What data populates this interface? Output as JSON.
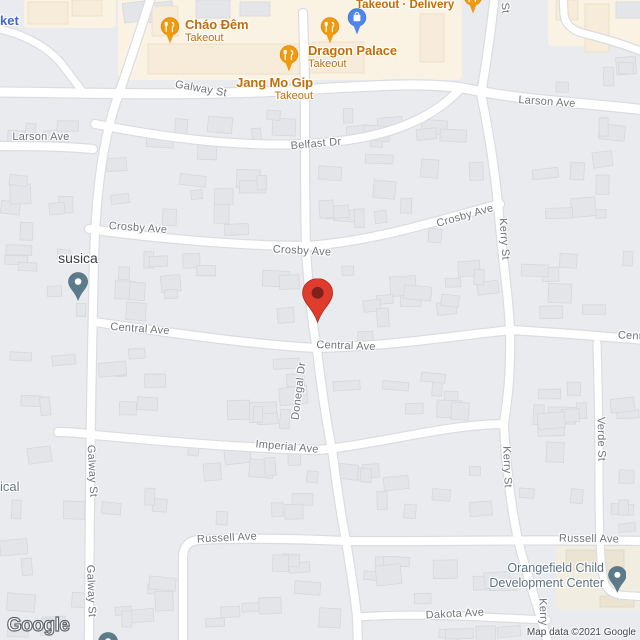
{
  "map": {
    "background": "#e9ebee",
    "road_fill": "#ffffff",
    "road_casing": "#dadce0",
    "building_fill": "#e3e5e9",
    "building_stroke": "#d5d8dc",
    "commercial_area_fill": "#faf3e4",
    "commercial_building_fill": "#f7ecd9",
    "commercial_building_stroke": "#eddec1",
    "school_area_fill": "#f1eee1",
    "school_building_fill": "#ebe4d3",
    "school_building_stroke": "#dfd5bd",
    "street_label_color": "#70757a",
    "food_pin_color": "#f09a10",
    "shopping_pin_color": "#4e86ec",
    "place_pin_color": "#5c7b8a",
    "destination_pin_color": "#df3c2d",
    "destination_pin_inner": "#7e231b",
    "areas": [
      {
        "x": 118,
        "y": -6,
        "w": 344,
        "h": 86,
        "fill": "commercial_area_fill"
      },
      {
        "x": 548,
        "y": -6,
        "w": 98,
        "h": 52,
        "fill": "commercial_area_fill"
      },
      {
        "x": 24,
        "y": -6,
        "w": 92,
        "h": 34,
        "fill": "commercial_area_fill"
      },
      {
        "x": 556,
        "y": 546,
        "w": 90,
        "h": 64,
        "fill": "school_area_fill"
      }
    ],
    "commercial_buildings": [
      {
        "x": 148,
        "y": 44,
        "w": 162,
        "h": 30
      },
      {
        "x": 312,
        "y": 42,
        "w": 52,
        "h": 31
      },
      {
        "x": 420,
        "y": 14,
        "w": 24,
        "h": 48
      },
      {
        "x": 585,
        "y": 4,
        "w": 24,
        "h": 48
      },
      {
        "x": 556,
        "y": 0,
        "w": 22,
        "h": 20
      },
      {
        "x": 28,
        "y": 2,
        "w": 40,
        "h": 22
      },
      {
        "x": 72,
        "y": 0,
        "w": 30,
        "h": 16
      },
      {
        "x": 152,
        "y": 6,
        "w": 26,
        "h": 30
      }
    ],
    "school_buildings": [
      {
        "x": 566,
        "y": 550,
        "w": 58,
        "h": 20
      },
      {
        "x": 600,
        "y": 596,
        "w": 34,
        "h": 11
      }
    ],
    "gray_structures": [
      {
        "x": 616,
        "y": 2,
        "w": 26,
        "h": 16
      },
      {
        "x": 196,
        "y": 0,
        "w": 34,
        "h": 18
      },
      {
        "x": 240,
        "y": 2,
        "w": 30,
        "h": 14
      }
    ],
    "blocks": [
      [
        0,
        100,
        88,
        52,
        4
      ],
      [
        0,
        172,
        86,
        466,
        26
      ],
      [
        105,
        108,
        192,
        130,
        18
      ],
      [
        315,
        103,
        175,
        142,
        20
      ],
      [
        100,
        248,
        205,
        84,
        13
      ],
      [
        322,
        255,
        180,
        86,
        14
      ],
      [
        95,
        342,
        215,
        92,
        14
      ],
      [
        330,
        358,
        172,
        64,
        9
      ],
      [
        100,
        443,
        222,
        88,
        14
      ],
      [
        338,
        458,
        164,
        74,
        10
      ],
      [
        196,
        552,
        148,
        84,
        9
      ],
      [
        360,
        548,
        172,
        58,
        9
      ],
      [
        362,
        626,
        168,
        16,
        4
      ],
      [
        518,
        112,
        122,
        215,
        16
      ],
      [
        518,
        348,
        74,
        184,
        11
      ],
      [
        606,
        348,
        34,
        184,
        6
      ],
      [
        538,
        56,
        102,
        38,
        4
      ],
      [
        104,
        548,
        72,
        90,
        6
      ],
      [
        118,
        2,
        62,
        30,
        3
      ]
    ],
    "roads": [
      {
        "d": "M -6,92 C 60,92 180,97 300,90 C 380,85 432,82 468,89 C 520,100 575,102 646,110",
        "w": 9
      },
      {
        "d": "M 152,-6 C 143,22 130,62 117,99",
        "w": 8
      },
      {
        "d": "M 117,99 C 103,140 96,190 94,260 C 92,350 90,430 89,646",
        "w": 8
      },
      {
        "d": "M -6,146 C 30,146 60,146 93,149",
        "w": 8
      },
      {
        "d": "M 95,124 C 180,141 262,149 332,142 C 392,136 434,117 460,89",
        "w": 8
      },
      {
        "d": "M 495,-6 C 492,20 488,55 481,94 C 489,132 496,176 500,226 C 505,280 509,302 510,330 C 511,380 507,400 504,424 C 506,470 511,506 518,540 C 528,580 541,616 549,646",
        "w": 8
      },
      {
        "d": "M 563,-6 L 564,14 C 565,25 573,31 586,34 C 606,39 626,45 646,53",
        "w": 7
      },
      {
        "d": "M 89,229 C 150,238 242,246 307,246 C 380,241 452,216 500,204",
        "w": 8
      },
      {
        "d": "M 94,322 C 160,331 252,345 318,348 C 392,346 452,336 512,330 C 560,333 600,336 646,340",
        "w": 8
      },
      {
        "d": "M 303,13 C 304,50 305,70 305,94 C 305,160 305,212 306,248 C 309,300 313,326 317,350 C 323,402 328,430 333,456 C 338,496 342,520 346,541 C 351,572 355,596 357,617 L 358,646",
        "w": 8
      },
      {
        "d": "M 58,432 C 70,432 82,433 94,435 C 160,441 242,448 318,450 C 362,446 420,432 462,427 C 480,425 494,424 504,424",
        "w": 8
      },
      {
        "d": "M 183,648 L 183,558 Q 183,541 199,540 C 258,537 320,540 346,541 C 430,542 520,539 646,541",
        "w": 8
      },
      {
        "d": "M 358,617 C 400,614 442,615 482,617 C 506,618 526,619 547,620",
        "w": 7
      },
      {
        "d": "M 597,343 C 598,380 599,420 599,460 C 599,500 599,524 600,540 C 601,562 602,574 605,584 Q 609,593 620,595 C 628,596 637,596 646,597",
        "w": 7
      },
      {
        "d": "M -6,28 C 18,32 44,44 60,62 C 68,72 76,83 82,91",
        "w": 7
      }
    ]
  },
  "streets": [
    {
      "text": "Galway St",
      "x": 201,
      "y": 89,
      "rot": 10
    },
    {
      "text": "Larson Ave",
      "x": 41,
      "y": 137,
      "rot": 0
    },
    {
      "text": "Larson Ave",
      "x": 547,
      "y": 102,
      "rot": 4
    },
    {
      "text": "Belfast Dr",
      "x": 316,
      "y": 144,
      "rot": -5
    },
    {
      "text": "Crosby Ave",
      "x": 138,
      "y": 228,
      "rot": 4
    },
    {
      "text": "Crosby Ave",
      "x": 302,
      "y": 251,
      "rot": 3
    },
    {
      "text": "Crosby Ave",
      "x": 465,
      "y": 216,
      "rot": -16
    },
    {
      "text": "Central Ave",
      "x": 140,
      "y": 329,
      "rot": 4
    },
    {
      "text": "Central Ave",
      "x": 346,
      "y": 346,
      "rot": 2
    },
    {
      "text": "Cent",
      "x": 630,
      "y": 336,
      "rot": 3
    },
    {
      "text": "Donegal Dr",
      "x": 299,
      "y": 391,
      "rot": -83
    },
    {
      "text": "Imperial Ave",
      "x": 287,
      "y": 447,
      "rot": 5
    },
    {
      "text": "Galway St",
      "x": 92,
      "y": 471,
      "rot": 87
    },
    {
      "text": "Galway St",
      "x": 91,
      "y": 591,
      "rot": 88
    },
    {
      "text": "Kerry St",
      "x": 504,
      "y": 239,
      "rot": 86
    },
    {
      "text": "Kerry St",
      "x": 507,
      "y": 467,
      "rot": 88
    },
    {
      "text": "Kerry",
      "x": 543,
      "y": 612,
      "rot": 87
    },
    {
      "text": "Verde St",
      "x": 601,
      "y": 439,
      "rot": 89
    },
    {
      "text": "Russell Ave",
      "x": 227,
      "y": 538,
      "rot": -3
    },
    {
      "text": "Russell Ave",
      "x": 589,
      "y": 539,
      "rot": 1
    },
    {
      "text": "Dakota Ave",
      "x": 455,
      "y": 614,
      "rot": -3
    },
    {
      "text": "St",
      "x": 505,
      "y": 8,
      "rot": 85
    }
  ],
  "pois": [
    {
      "id": "chao-dem",
      "type": "restaurant",
      "name": "Cháo Đêm",
      "sub": "Takeout",
      "pin": {
        "x": 170,
        "y": 43,
        "s": 1
      },
      "label": {
        "x": 185,
        "y": 18,
        "align": "left"
      }
    },
    {
      "id": "dragon-palace",
      "type": "restaurant",
      "name": "Dragon Palace",
      "sub": "Takeout",
      "pin": {
        "x": 330,
        "y": 43,
        "s": 1
      },
      "label": {
        "x": 308,
        "y": 44,
        "align": "left"
      }
    },
    {
      "id": "jang-mo-gip",
      "type": "restaurant",
      "name": "Jang Mo Gip",
      "sub": "Takeout",
      "pin": {
        "x": 289,
        "y": 71,
        "s": 1
      },
      "label": {
        "x": 313,
        "y": 76,
        "align": "right"
      }
    },
    {
      "id": "takeout-delivery",
      "type": "food-sub",
      "sub": "Takeout · Delivery",
      "label": {
        "x": 356,
        "y": -1,
        "align": "left"
      }
    },
    {
      "id": "restaurant-partial-top",
      "type": "restaurant",
      "pin": {
        "x": 473,
        "y": 13,
        "s": 1
      }
    },
    {
      "id": "shopping-place",
      "type": "shopping",
      "pin": {
        "x": 357,
        "y": 34,
        "s": 1
      }
    },
    {
      "id": "market-partial",
      "type": "shop-label",
      "name": "ket",
      "label": {
        "x": 0,
        "y": 13,
        "align": "left"
      }
    },
    {
      "id": "medical-partial",
      "type": "gray-label",
      "name": "ical",
      "label": {
        "x": 0,
        "y": 479,
        "align": "left"
      }
    },
    {
      "id": "susica",
      "type": "place",
      "name": "susica",
      "pin": {
        "x": 78,
        "y": 301,
        "s": 0.84
      },
      "label": {
        "x": 78,
        "y": 250,
        "align": "center"
      }
    },
    {
      "id": "orangefield-center",
      "type": "place2",
      "name": "Orangefield Child",
      "name2": "Development Center",
      "pin": {
        "x": 617,
        "y": 593,
        "s": 0.78
      },
      "label": {
        "x": 604,
        "y": 561,
        "align": "right"
      }
    },
    {
      "id": "place-partial-bottom",
      "type": "place",
      "pin": {
        "x": 108,
        "y": 661,
        "s": 0.84
      }
    },
    {
      "id": "destination",
      "type": "destination",
      "pin": {
        "x": 318,
        "y": 322,
        "s": 1.3
      }
    }
  ],
  "attribution": {
    "logo": "Google",
    "text": "Map data ©2021 Google"
  }
}
